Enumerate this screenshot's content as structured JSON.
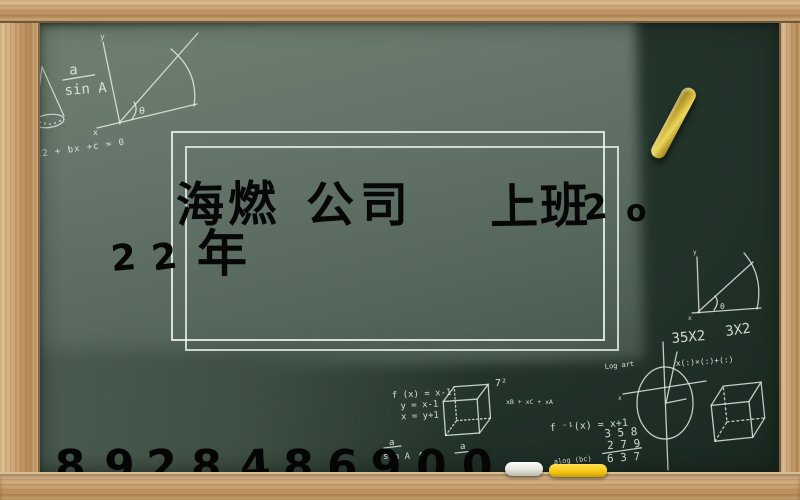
{
  "scene": "chalkboard with wooden frame",
  "title": {
    "row1": [
      "海燃",
      "公司",
      "上班",
      "2",
      "o"
    ],
    "row2": [
      "2",
      "2",
      "年"
    ]
  },
  "phone": {
    "digits": [
      "1",
      "8",
      "9",
      "2",
      "8",
      "4",
      "8",
      "6",
      "9",
      "0",
      "0"
    ],
    "full": "18928486900"
  },
  "chalk": {
    "fraction1_numerator": "a",
    "fraction1_denominator": "sin A",
    "axis1_y_label": "y",
    "axis1_x_label": "x",
    "axis1_angle": "θ",
    "quadratic": "ax2 + bx +c = 0",
    "axis2_angle": "θ",
    "axis2_y_label": "y",
    "axis2_x_label": "x",
    "mult1": "35X2",
    "mult2": "3X2",
    "matrix_expr": "x(:)×(:)+(:)",
    "log_label": "Log art",
    "circle_x_label": "x",
    "fx_line1": "f (x) = x-1",
    "fx_line2": "y = x-1",
    "fx_line3": "x = y+1",
    "seven_squared": "7²",
    "small_expr": "xB + xC + xA",
    "f_inverse": "f ⁻¹(x) = x+1",
    "sum_row1": "3 5 8",
    "sum_row2": "2 7 9",
    "sum_row3": "6 3 7",
    "alog_label": "alog (bc)",
    "fraction2_numerator": "a",
    "fraction2_denominator": "sin A",
    "angle_question": "o?",
    "fraction3_numerator": "a"
  },
  "objects": {
    "yellow_chalk_air": "yellow chalk stick on board",
    "white_chalk_tray": "white chalk stick on tray",
    "yellow_chalk_tray": "yellow chalk stick on tray"
  },
  "colors": {
    "board_light": "#68786c",
    "board_dark": "#22332a",
    "wood": "#c9a071",
    "chalk_white": "#e8efe7",
    "chalk_yellow": "#f2c51d",
    "marker_black": "#070707"
  }
}
